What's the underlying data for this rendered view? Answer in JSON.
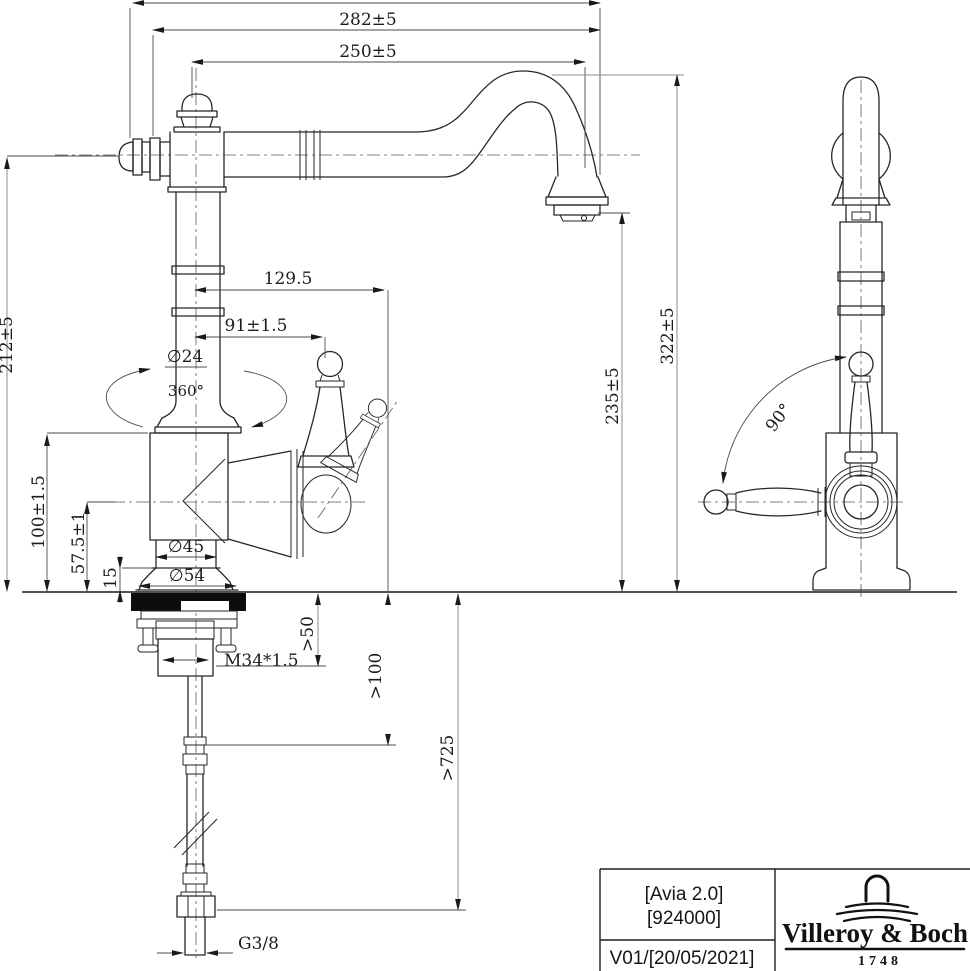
{
  "page": {
    "background": "#ffffff",
    "line_color": "#26262b",
    "dimension_color": "#4b4b4b"
  },
  "front_view": {
    "dim_overall_width": "282±5",
    "dim_spout_reach": "250±5",
    "dim_handle_tilted_offset": "129.5",
    "dim_handle_offset": "91±1.5",
    "dim_column_diameter": "∅24",
    "dim_swivel_angle": "360°",
    "dim_height_to_spout_axis": "212±5",
    "dim_body_height": "100±1.5",
    "dim_body_axis_height": "57.5±1",
    "dim_base_ring_height": "15",
    "dim_body_diameter": "∅45",
    "dim_base_diameter": "∅54",
    "dim_mounting_thread": "M34*1.5",
    "dim_shank_clearance": ">50",
    "dim_hose_clearance": ">100",
    "dim_hose_length": ">725",
    "dim_hose_connection": "G3/8",
    "dim_spout_top_height": "322±5",
    "dim_outlet_height": "235±5"
  },
  "side_view": {
    "dim_handle_swing_angle": "90°"
  },
  "title_block": {
    "product_name": "[Avia 2.0]",
    "article_number": "[924000]",
    "revision_date": "V01/[20/05/2021]",
    "brand_name": "Villeroy & Boch",
    "brand_founded": "1748"
  }
}
